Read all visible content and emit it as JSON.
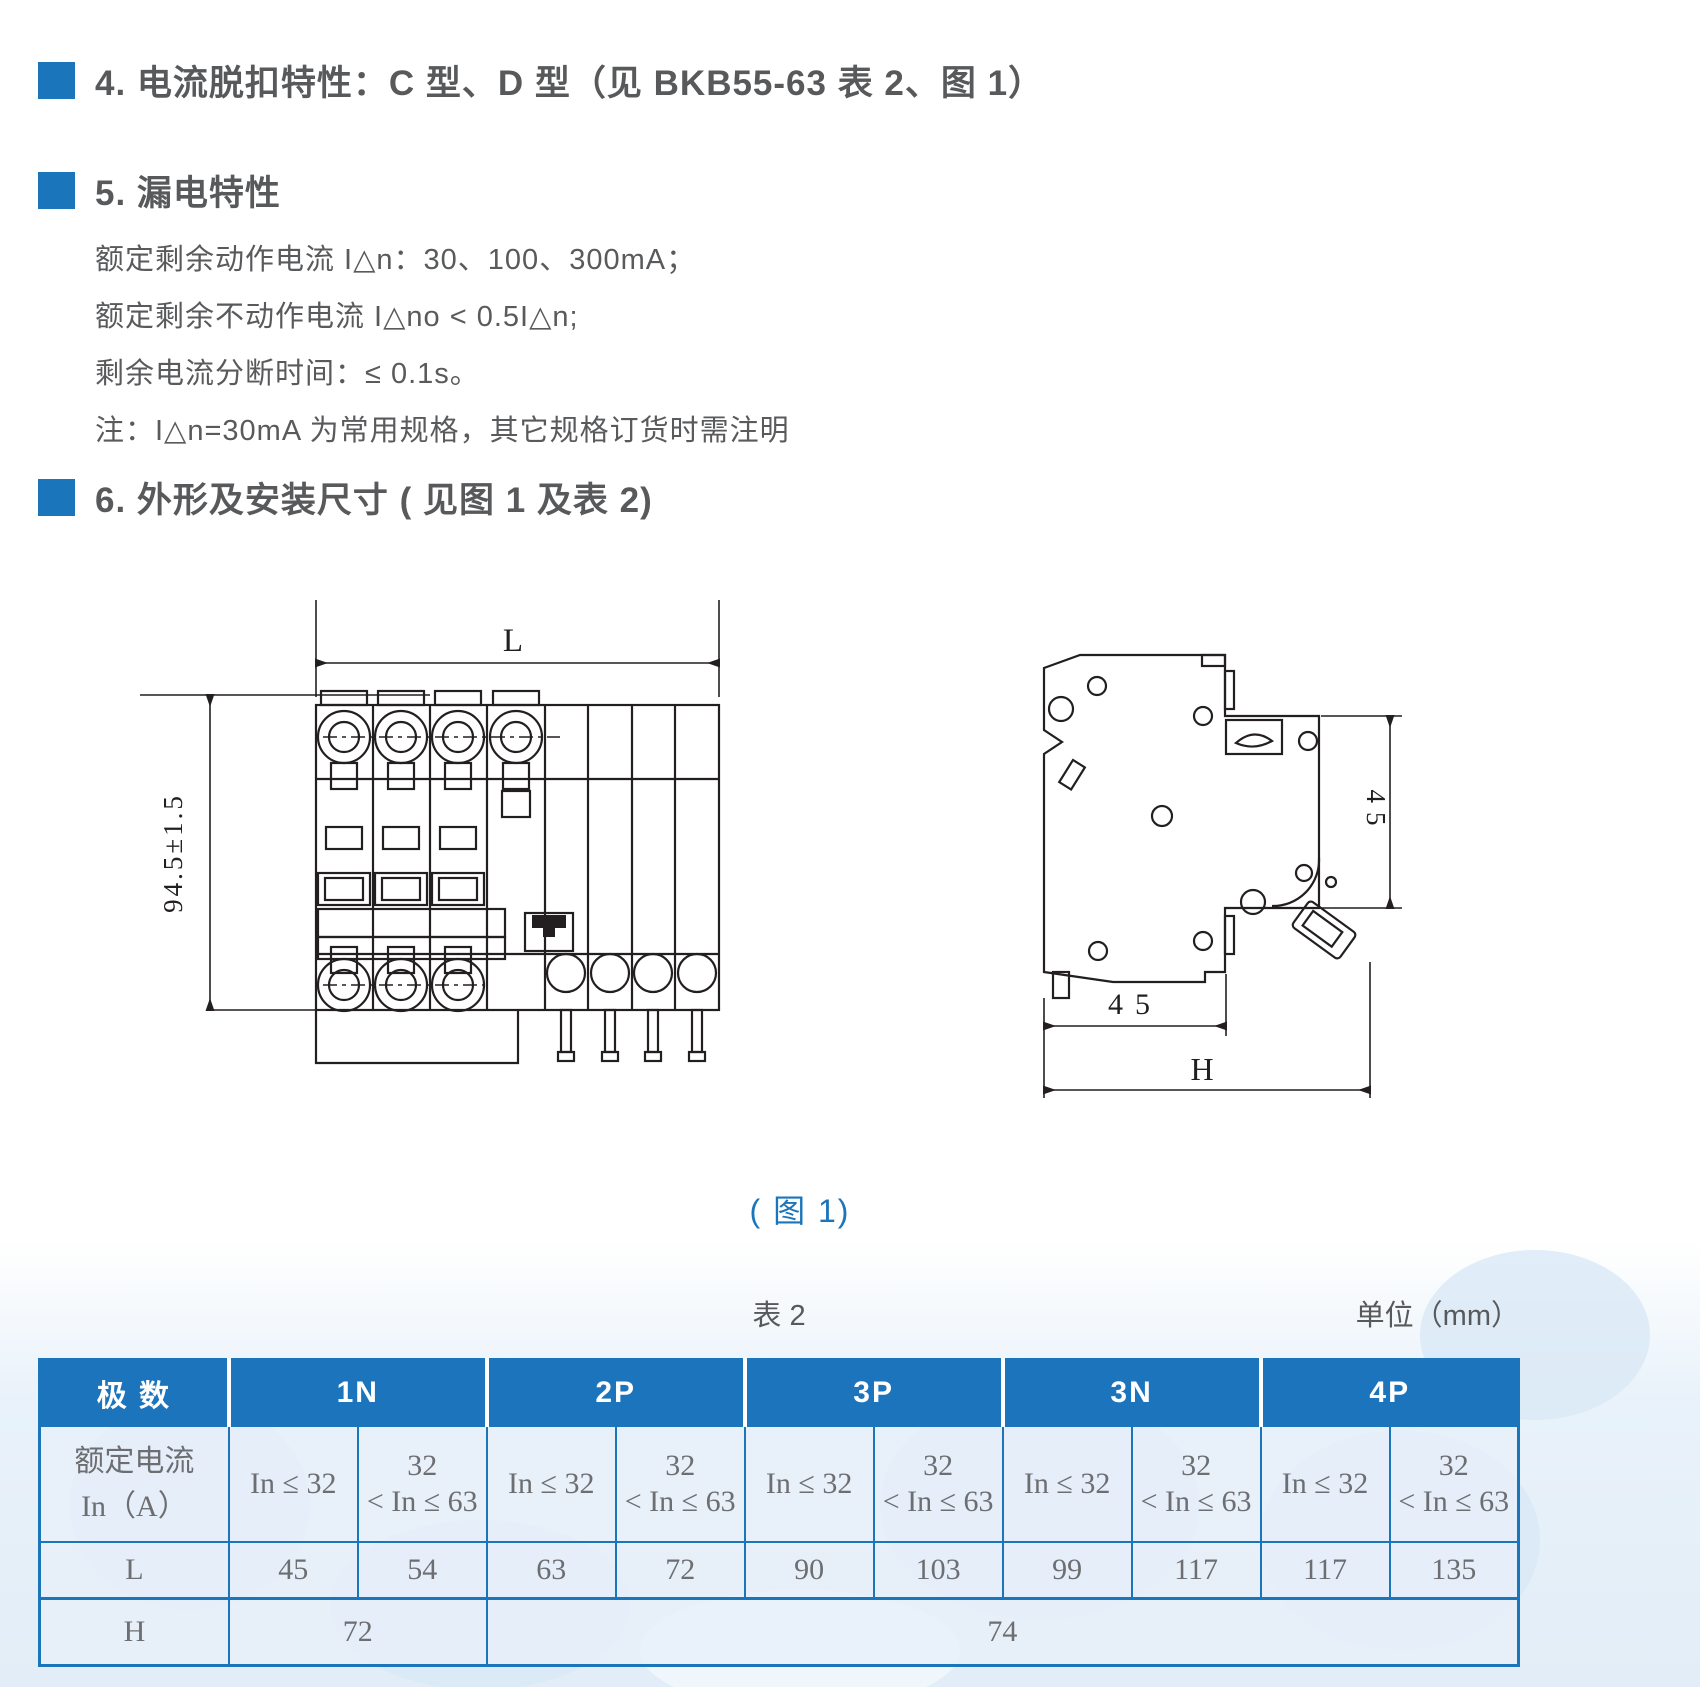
{
  "sections": {
    "s4": {
      "title": "4. 电流脱扣特性：C 型、D 型（见 BKB55-63 表 2、图 1）"
    },
    "s5": {
      "title": "5. 漏电特性",
      "lines": [
        "额定剩余动作电流 I△n：30、100、300mA；",
        "额定剩余不动作电流 I△no < 0.5I△n;",
        "剩余电流分断时间：≤ 0.1s。",
        "注：I△n=30mA 为常用规格，其它规格订货时需注明"
      ]
    },
    "s6": {
      "title": "6. 外形及安装尺寸 ( 见图 1 及表 2)"
    }
  },
  "figure": {
    "caption": "( 图 1)",
    "front": {
      "width_label": "L",
      "height_label": "94.5±1.5"
    },
    "side": {
      "right_label": "45",
      "bottom_label": "45",
      "height_label": "H"
    }
  },
  "table": {
    "caption": "表 2",
    "unit": "单位（mm）",
    "corner": "极 数",
    "groups": [
      "1N",
      "2P",
      "3P",
      "3N",
      "4P"
    ],
    "rated_label_1": "额定电流",
    "rated_label_2": "In（A）",
    "range_low": "In ≤ 32",
    "range_high_top": "32",
    "range_high_bottom": "< In ≤ 63",
    "row_L": {
      "label": "L",
      "values": [
        "45",
        "54",
        "63",
        "72",
        "90",
        "103",
        "99",
        "117",
        "117",
        "135"
      ]
    },
    "row_H": {
      "label": "H",
      "values": [
        "72",
        "74"
      ]
    }
  },
  "colors": {
    "accent_blue": "#1b75bb",
    "table_header_bg": "#1c75bc",
    "heading_text": "#58595b",
    "table_text": "#6d6e71",
    "drawing_line": "#231f20"
  }
}
